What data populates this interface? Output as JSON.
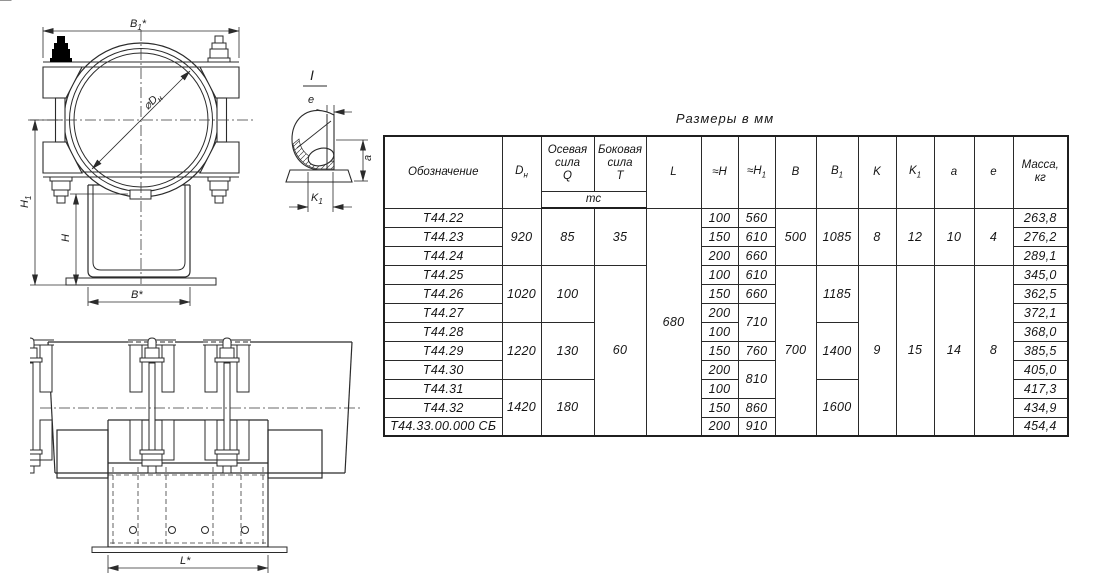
{
  "title": "Размеры в мм",
  "table": {
    "headers": {
      "designation": "Обозначение",
      "dn": {
        "base": "D",
        "sub": "н"
      },
      "axial_force": "Осевая\nсила\nQ",
      "lateral_force": "Боковая\nсила\nT",
      "force_units": "тс",
      "l": "L",
      "h": "≈H",
      "h1": {
        "base": "≈H",
        "sub": "1"
      },
      "b": "B",
      "b1": {
        "base": "B",
        "sub": "1"
      },
      "k": "K",
      "k1": {
        "base": "K",
        "sub": "1"
      },
      "a": "a",
      "e": "e",
      "mass": "Масса,\nкг"
    },
    "merged": {
      "dn": [
        "920",
        "1020",
        "1220",
        "1420"
      ],
      "q": [
        "85",
        "100",
        "130",
        "180"
      ],
      "t": [
        "35",
        "60"
      ],
      "l": "680",
      "b": [
        "500",
        "700"
      ],
      "b1": [
        "1085",
        "1185",
        "1400",
        "1600"
      ],
      "k": [
        "8",
        "9"
      ],
      "k1": [
        "12",
        "15"
      ],
      "a": [
        "10",
        "14"
      ],
      "e": [
        "4",
        "8"
      ]
    },
    "rows": [
      {
        "designation": "Т44.22",
        "h": "100",
        "h1": "560",
        "mass": "263,8"
      },
      {
        "designation": "Т44.23",
        "h": "150",
        "h1": "610",
        "mass": "276,2"
      },
      {
        "designation": "Т44.24",
        "h": "200",
        "h1": "660",
        "mass": "289,1"
      },
      {
        "designation": "Т44.25",
        "h": "100",
        "h1": "610",
        "mass": "345,0"
      },
      {
        "designation": "Т44.26",
        "h": "150",
        "h1": "660",
        "mass": "362,5"
      },
      {
        "designation": "Т44.27",
        "h": "200",
        "h1": "710",
        "mass": "372,1"
      },
      {
        "designation": "Т44.28",
        "h": "100",
        "mass": "368,0"
      },
      {
        "designation": "Т44.29",
        "h": "150",
        "h1": "760",
        "mass": "385,5"
      },
      {
        "designation": "Т44.30",
        "h": "200",
        "h1": "810",
        "mass": "405,0"
      },
      {
        "designation": "Т44.31",
        "h": "100",
        "mass": "417,3"
      },
      {
        "designation": "Т44.32",
        "h": "150",
        "h1": "860",
        "mass": "434,9"
      },
      {
        "designation": "Т44.33.00.000 СБ",
        "h": "200",
        "h1": "910",
        "mass": "454,4"
      }
    ]
  },
  "drawings": {
    "front_view": {
      "dim_b1_top": {
        "base": "B",
        "sub": "1",
        "suffix": "*"
      },
      "dim_diameter": {
        "base": "⌀D",
        "sub": "н"
      },
      "dim_h1": {
        "base": "H",
        "sub": "1"
      },
      "dim_h": "H",
      "dim_b_bottom": "B*"
    },
    "detail_view": {
      "label": "I",
      "dim_e": "e",
      "dim_a": "a",
      "dim_k1": {
        "base": "K",
        "sub": "1"
      }
    },
    "side_view": {
      "dim_l": "L*"
    }
  },
  "colors": {
    "line": "#2b2b2b",
    "background": "#ffffff"
  }
}
